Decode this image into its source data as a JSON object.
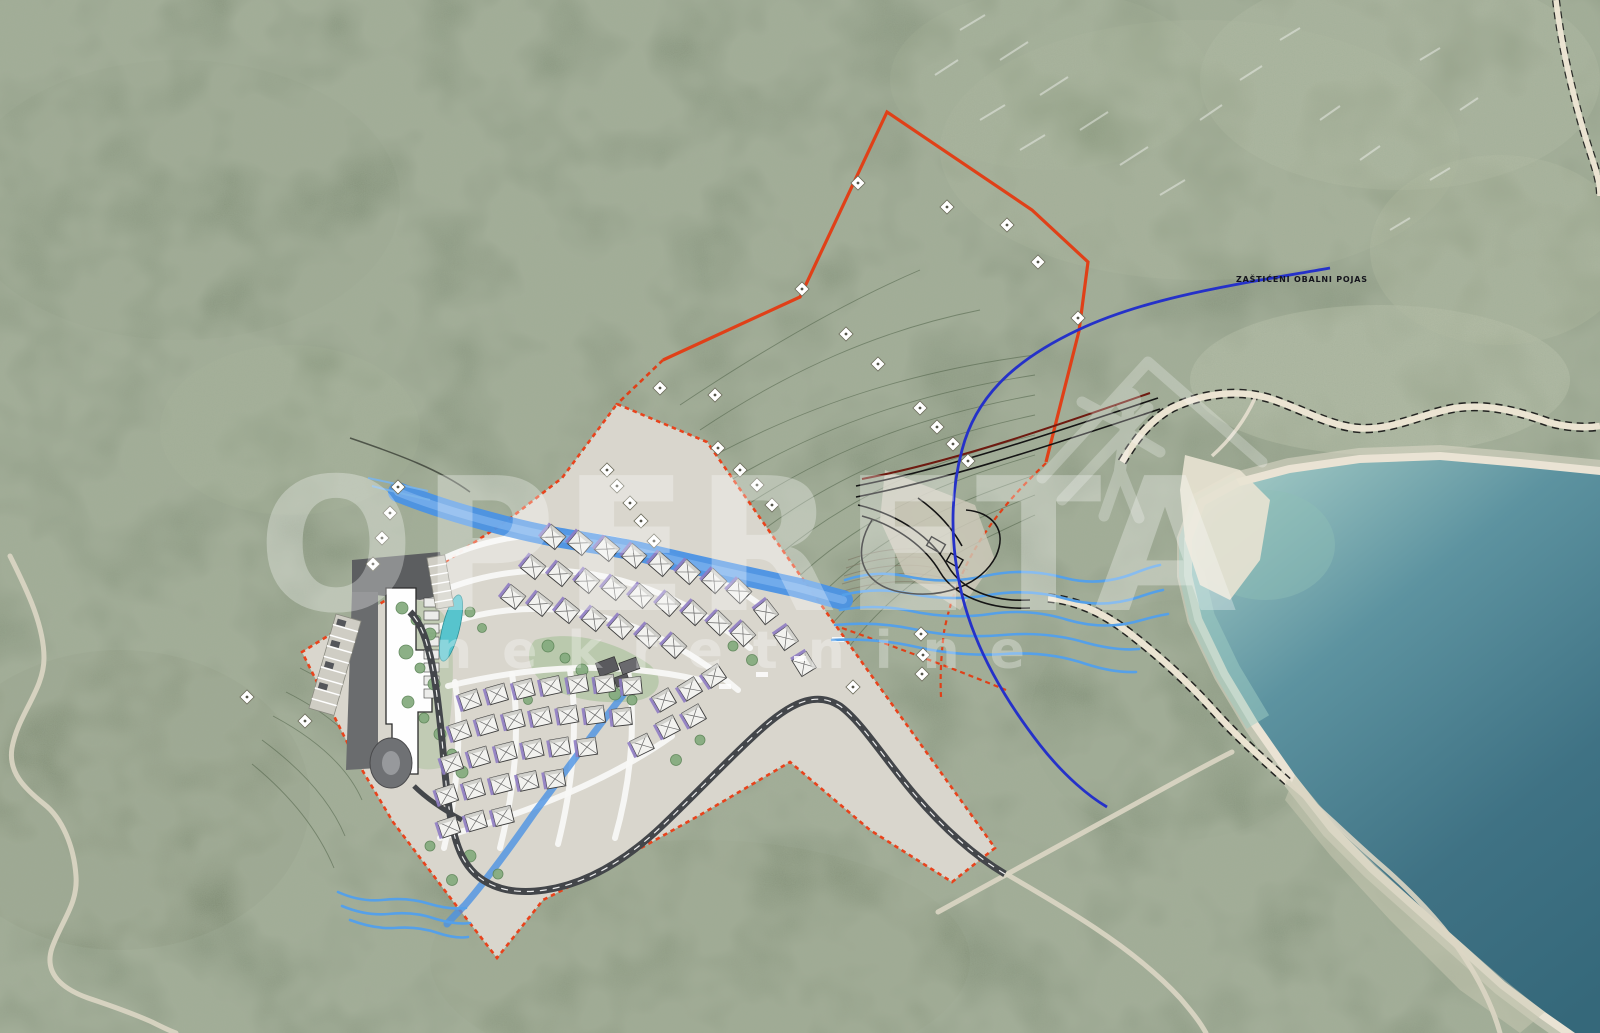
{
  "page": {
    "title": "Aerial masterplan site photo",
    "width": 1600,
    "height": 1033
  },
  "watermark": {
    "title": "OPERETA",
    "subtitle": "nekretnine",
    "logo": "house-person-logo"
  },
  "annotations": {
    "coastal_belt_label": "ZAŠTIĆENI OBALNI POJAS"
  },
  "legend_colors": {
    "aerial_forest": "#7b8871",
    "aerial_light": "#97a186",
    "sea_deep": "#35687a",
    "sea_mid": "#4d8593",
    "sea_shallow": "#aed3cb",
    "shoreline_rock": "#ece5d6",
    "plan_ground": "#d9d6cd",
    "parcel_boundary_solid": "#e04018",
    "development_boundary_dashed": "#e8431c",
    "protected_belt_line": "#2531c9",
    "river": "#4b92e4",
    "coast_road": "#ebe4d2",
    "internal_road": "#43464a",
    "villa_roof": "#f2f2ef",
    "villa_accent": "#8e7cc3",
    "hotel_building": "#fefefe",
    "pool": "#57c4cd",
    "tree": "#86ac80",
    "watermark": "#ffffff"
  },
  "site_plan": {
    "villas": [
      [
        553,
        537,
        40
      ],
      [
        580,
        543,
        40
      ],
      [
        607,
        549,
        40
      ],
      [
        634,
        556,
        40
      ],
      [
        661,
        564,
        41
      ],
      [
        688,
        572,
        42
      ],
      [
        714,
        581,
        43
      ],
      [
        739,
        591,
        44
      ],
      [
        533,
        567,
        39
      ],
      [
        560,
        574,
        39
      ],
      [
        587,
        581,
        40
      ],
      [
        614,
        588,
        40
      ],
      [
        641,
        596,
        41
      ],
      [
        668,
        604,
        42
      ],
      [
        694,
        613,
        43
      ],
      [
        719,
        623,
        44
      ],
      [
        743,
        634,
        46
      ],
      [
        513,
        597,
        38
      ],
      [
        540,
        604,
        38
      ],
      [
        567,
        611,
        39
      ],
      [
        594,
        619,
        40
      ],
      [
        621,
        627,
        41
      ],
      [
        648,
        636,
        42
      ],
      [
        674,
        646,
        43
      ],
      [
        766,
        612,
        52
      ],
      [
        786,
        638,
        55
      ],
      [
        804,
        664,
        58
      ],
      [
        470,
        700,
        -18
      ],
      [
        497,
        694,
        -16
      ],
      [
        524,
        689,
        -14
      ],
      [
        551,
        686,
        -12
      ],
      [
        578,
        684,
        -10
      ],
      [
        605,
        684,
        -8
      ],
      [
        632,
        686,
        -6
      ],
      [
        460,
        731,
        -18
      ],
      [
        487,
        725,
        -16
      ],
      [
        514,
        720,
        -14
      ],
      [
        541,
        717,
        -12
      ],
      [
        568,
        715,
        -10
      ],
      [
        595,
        715,
        -8
      ],
      [
        622,
        717,
        -6
      ],
      [
        452,
        763,
        -18
      ],
      [
        479,
        757,
        -16
      ],
      [
        506,
        752,
        -14
      ],
      [
        533,
        749,
        -12
      ],
      [
        560,
        747,
        -10
      ],
      [
        587,
        747,
        -8
      ],
      [
        447,
        795,
        -18
      ],
      [
        474,
        789,
        -16
      ],
      [
        501,
        784,
        -14
      ],
      [
        528,
        781,
        -12
      ],
      [
        555,
        779,
        -10
      ],
      [
        449,
        827,
        -18
      ],
      [
        476,
        821,
        -16
      ],
      [
        503,
        816,
        -14
      ],
      [
        664,
        700,
        -30
      ],
      [
        690,
        689,
        -32
      ],
      [
        714,
        676,
        -34
      ],
      [
        668,
        727,
        -28
      ],
      [
        694,
        716,
        -30
      ],
      [
        642,
        745,
        -26
      ]
    ],
    "survey_markers": [
      [
        858,
        183
      ],
      [
        947,
        207
      ],
      [
        1007,
        225
      ],
      [
        1038,
        262
      ],
      [
        1078,
        318
      ],
      [
        802,
        289
      ],
      [
        846,
        334
      ],
      [
        878,
        364
      ],
      [
        920,
        408
      ],
      [
        937,
        427
      ],
      [
        953,
        444
      ],
      [
        968,
        461
      ],
      [
        660,
        388
      ],
      [
        715,
        395
      ],
      [
        718,
        448
      ],
      [
        740,
        470
      ],
      [
        757,
        485
      ],
      [
        772,
        505
      ],
      [
        607,
        470
      ],
      [
        617,
        486
      ],
      [
        630,
        503
      ],
      [
        641,
        521
      ],
      [
        654,
        541
      ],
      [
        398,
        487
      ],
      [
        390,
        513
      ],
      [
        382,
        538
      ],
      [
        373,
        564
      ],
      [
        247,
        697
      ],
      [
        305,
        721
      ],
      [
        853,
        687
      ],
      [
        921,
        634
      ],
      [
        923,
        655
      ],
      [
        922,
        674
      ]
    ]
  }
}
